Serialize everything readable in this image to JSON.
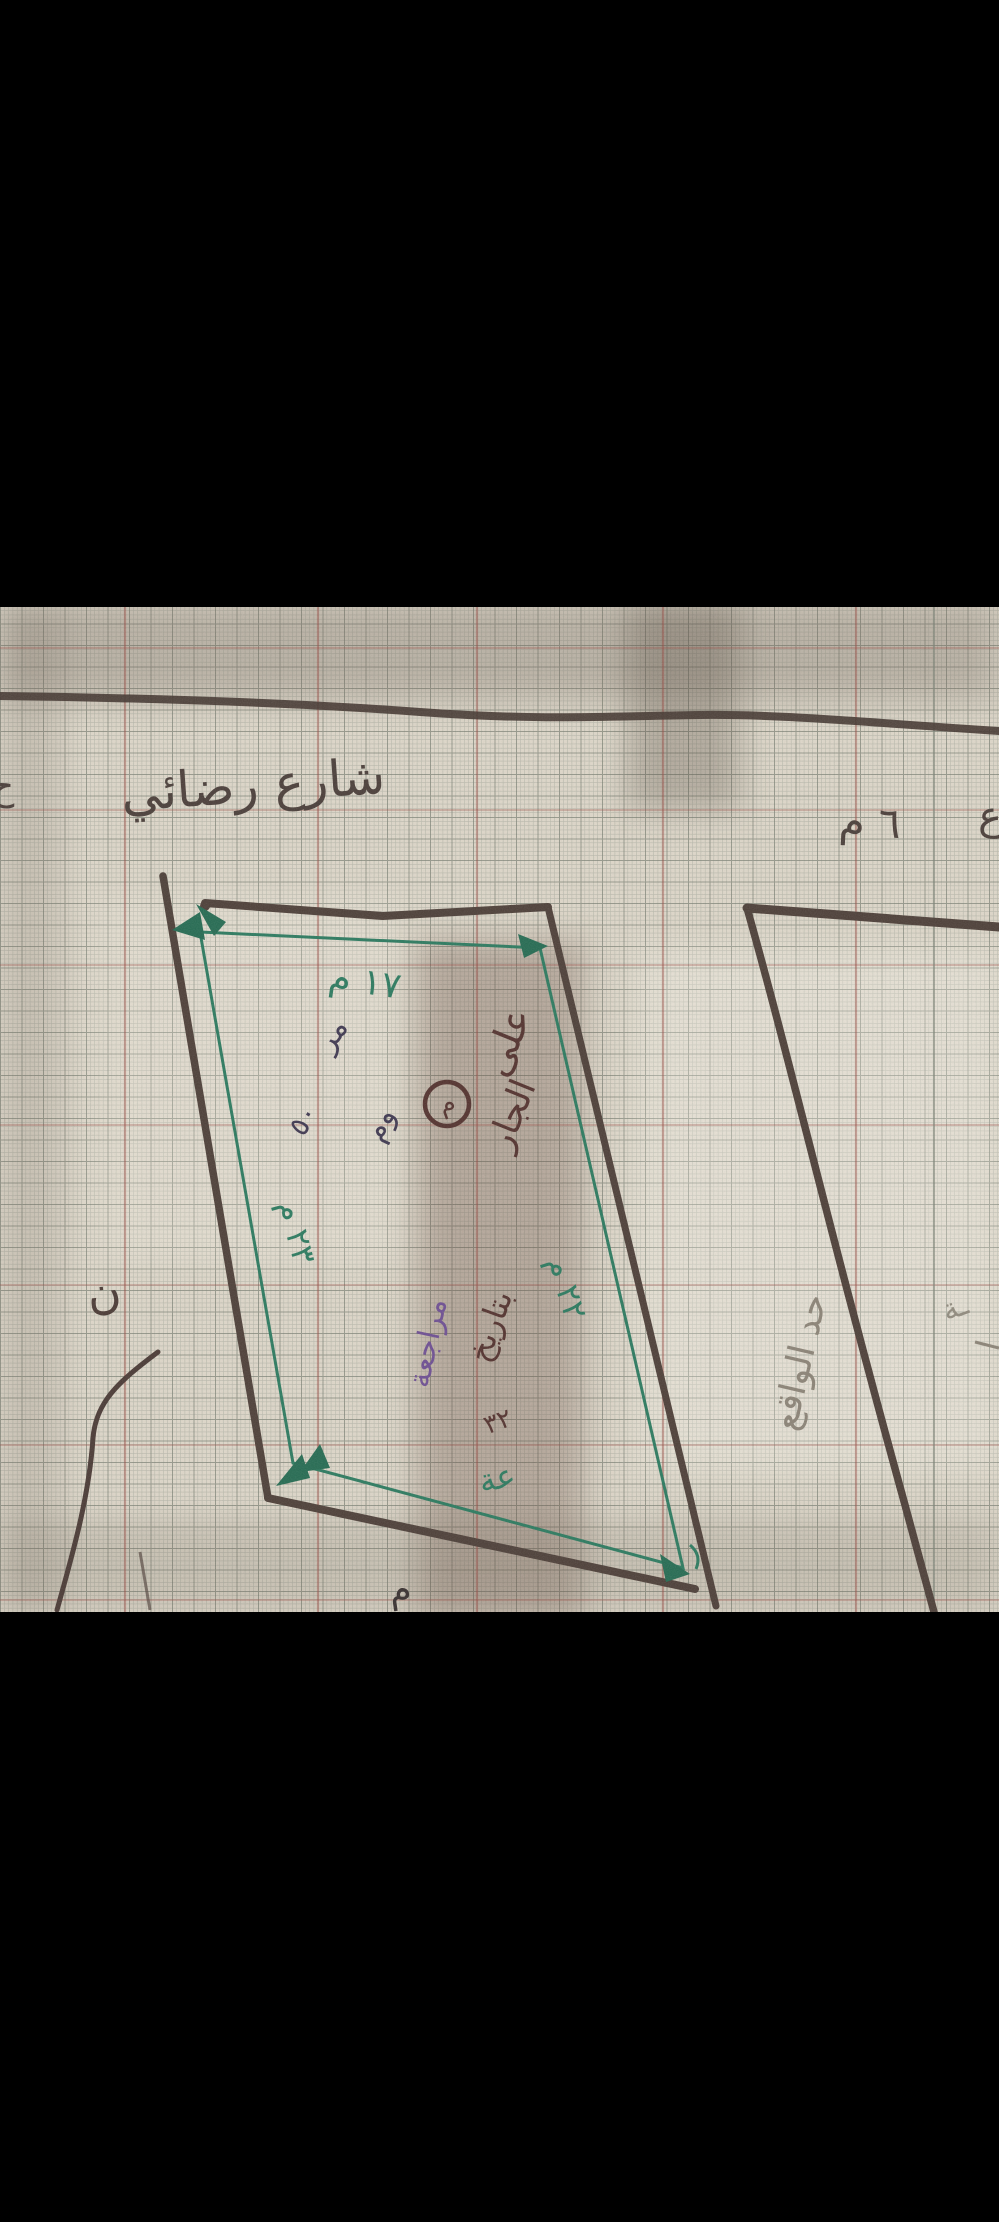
{
  "photo": {
    "street": {
      "name": "شارع رضائي",
      "width_label": "٦ م",
      "right_edge_partial": "ع",
      "left_edge_partial": "ح"
    },
    "plot_dimensions": {
      "top": "١٧ م",
      "left": "٢٣ م",
      "right": "٢٢ م"
    },
    "handwritten_notes": {
      "note_small_1": "مر",
      "note_small_2": "٥٠",
      "note_small_3": "وم",
      "circled_mark": "م",
      "note_ala": "على",
      "note_jar": "الجار",
      "note_tarikh": "بتاريخ",
      "note_purple": "مراجعة",
      "note_fraction": "٣٢",
      "note_green": "عة",
      "bottom_mark": "م",
      "left_letter": "ن"
    },
    "neighbor": {
      "boundary_label": "حد الواقع",
      "edge_partial": "ـة"
    },
    "colors": {
      "ink_dark": "#453832",
      "ink_blue": "#3f3850",
      "ink_green": "#2c7a5f",
      "ink_maroon": "#53322e",
      "ink_purple": "#6e4f92",
      "pencil": "#8b8376",
      "paper": "#ded7c9",
      "grid_red": "#9a4a42"
    }
  }
}
